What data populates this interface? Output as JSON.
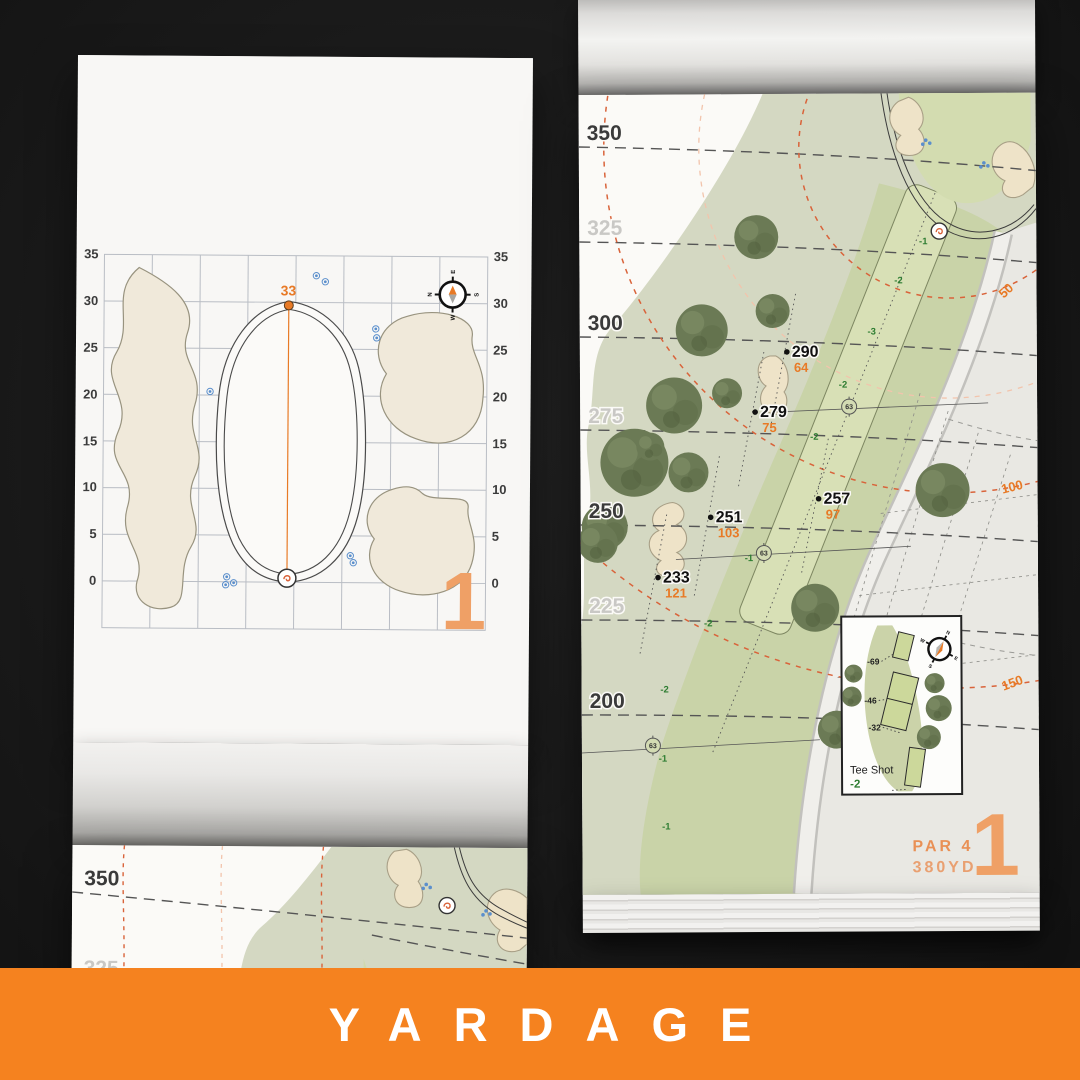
{
  "banner": {
    "label": "YARDAGE",
    "bg": "#f5821f"
  },
  "hole": {
    "number": "1",
    "par": "PAR 4",
    "yardage": "380YD"
  },
  "green_page": {
    "pin_distance": "33",
    "hole_number": "1",
    "axis": [
      "35",
      "30",
      "25",
      "20",
      "15",
      "10",
      "5",
      "0"
    ],
    "compass": {
      "n": "N",
      "e": "E",
      "s": "S",
      "w": "W"
    }
  },
  "map_page": {
    "yardlines": [
      "350",
      "325",
      "300",
      "275",
      "250",
      "225",
      "200"
    ],
    "arc_marks": [
      "50",
      "100",
      "150"
    ],
    "points": [
      {
        "carry": "290",
        "to_green": "64"
      },
      {
        "carry": "279",
        "to_green": "75"
      },
      {
        "carry": "257",
        "to_green": "97"
      },
      {
        "carry": "251",
        "to_green": "103"
      },
      {
        "carry": "233",
        "to_green": "121"
      }
    ],
    "center_marks": [
      "63",
      "63",
      "63"
    ],
    "width_marks": [
      "-1",
      "-2",
      "-3",
      "-2",
      "-2",
      "-1",
      "-2",
      "-2",
      "-1",
      "-1"
    ],
    "tee_inset": {
      "title": "Tee Shot",
      "value": "-2",
      "offsets": [
        "-69",
        "-46",
        "-32"
      ]
    },
    "compass": {
      "n": "N",
      "e": "E",
      "s": "S",
      "w": "W"
    }
  },
  "partial_page": {
    "yardlines": [
      "350",
      "325"
    ]
  },
  "colors": {
    "accent": "#e87a26",
    "banner": "#f5821f",
    "fairway": "#c9d3a8",
    "rough": "#d4d8c2",
    "sand": "#eee3c8",
    "tree": "#6b7a55",
    "ink": "#333333",
    "muted": "#c9c8c5",
    "green_label": "#2e7d32",
    "blue": "#5b8fcc"
  }
}
